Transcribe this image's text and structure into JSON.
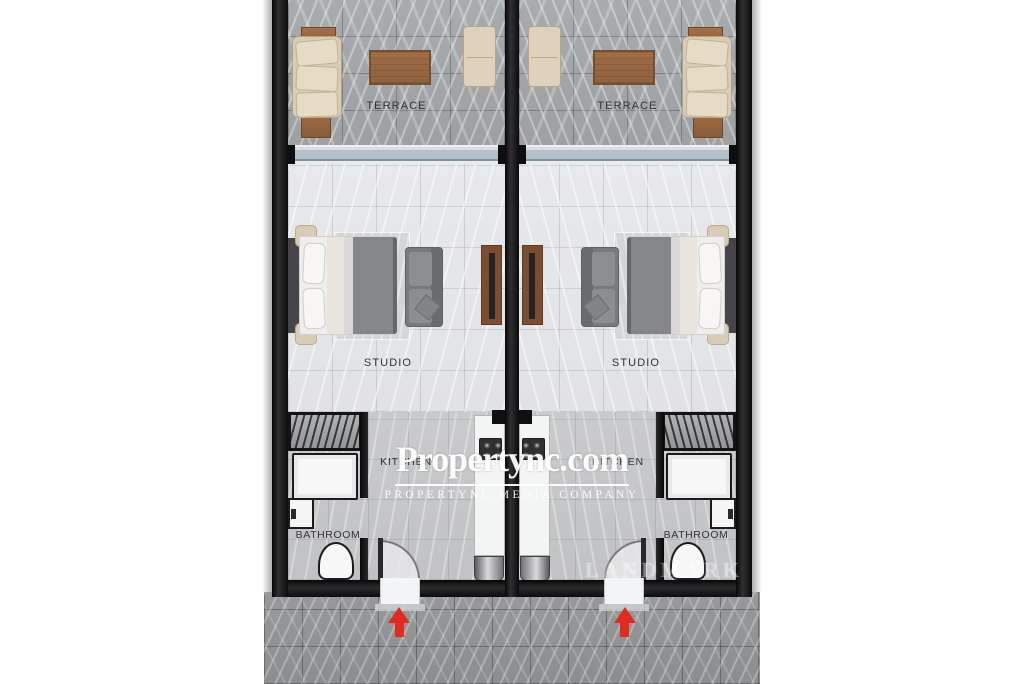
{
  "watermark": {
    "brand": "Propertync.com",
    "tagline": "PROPERTYNC MEDIA COMPANY",
    "agency": "LANDMARK"
  },
  "units": [
    {
      "name": "left-studio-unit",
      "terrace_label": "TERRACE",
      "studio_label": "STUDIO",
      "kitchen_label": "KITCHEN",
      "bathroom_label": "BATHROOM"
    },
    {
      "name": "right-studio-unit",
      "terrace_label": "TERRACE",
      "studio_label": "STUDIO",
      "kitchen_label": "KITCHEN",
      "bathroom_label": "BATHROOM"
    }
  ],
  "entry": {
    "direction": "up",
    "arrow_color": "#e02b20"
  },
  "colors": {
    "wall": "#121214",
    "terrace_floor": "#a4a7a9",
    "studio_floor": "#e6e7e9",
    "entry_floor": "#c6c7c9",
    "pavement": "#939597",
    "glass_door": "#b3c2c8",
    "wood": "#9c6b45",
    "upholstery_beige": "#d9ccb4",
    "upholstery_gray": "#797a7d",
    "watermark_white": "#ffffff"
  }
}
